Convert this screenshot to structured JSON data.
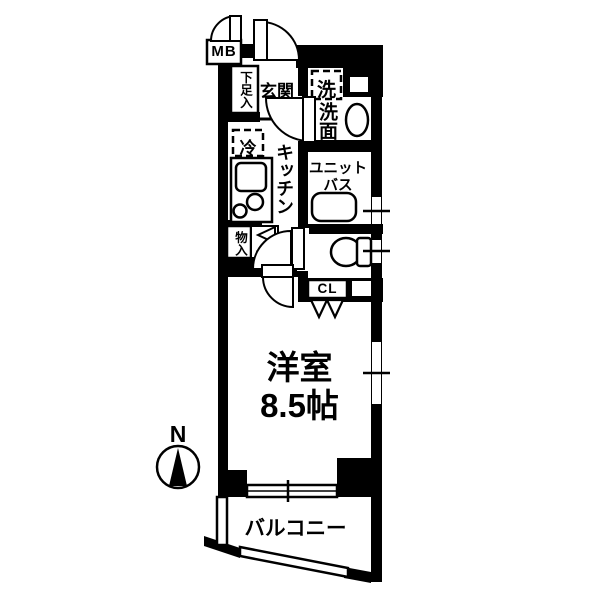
{
  "floorplan": {
    "compass": {
      "north": "N"
    },
    "labels": {
      "meter_box": "MB",
      "shoe_storage": "下足入",
      "entrance": "玄関",
      "washer": "洗",
      "washroom": "洗面",
      "fridge": "冷",
      "kitchen": "キッチン",
      "unit_bath_line1": "ユニット",
      "unit_bath_line2": "バス",
      "storage": "物入",
      "closet": "CL",
      "room_name": "洋室",
      "room_size": "8.5帖",
      "balcony": "バルコニー"
    },
    "colors": {
      "wall": "#000000",
      "background": "#ffffff"
    }
  }
}
